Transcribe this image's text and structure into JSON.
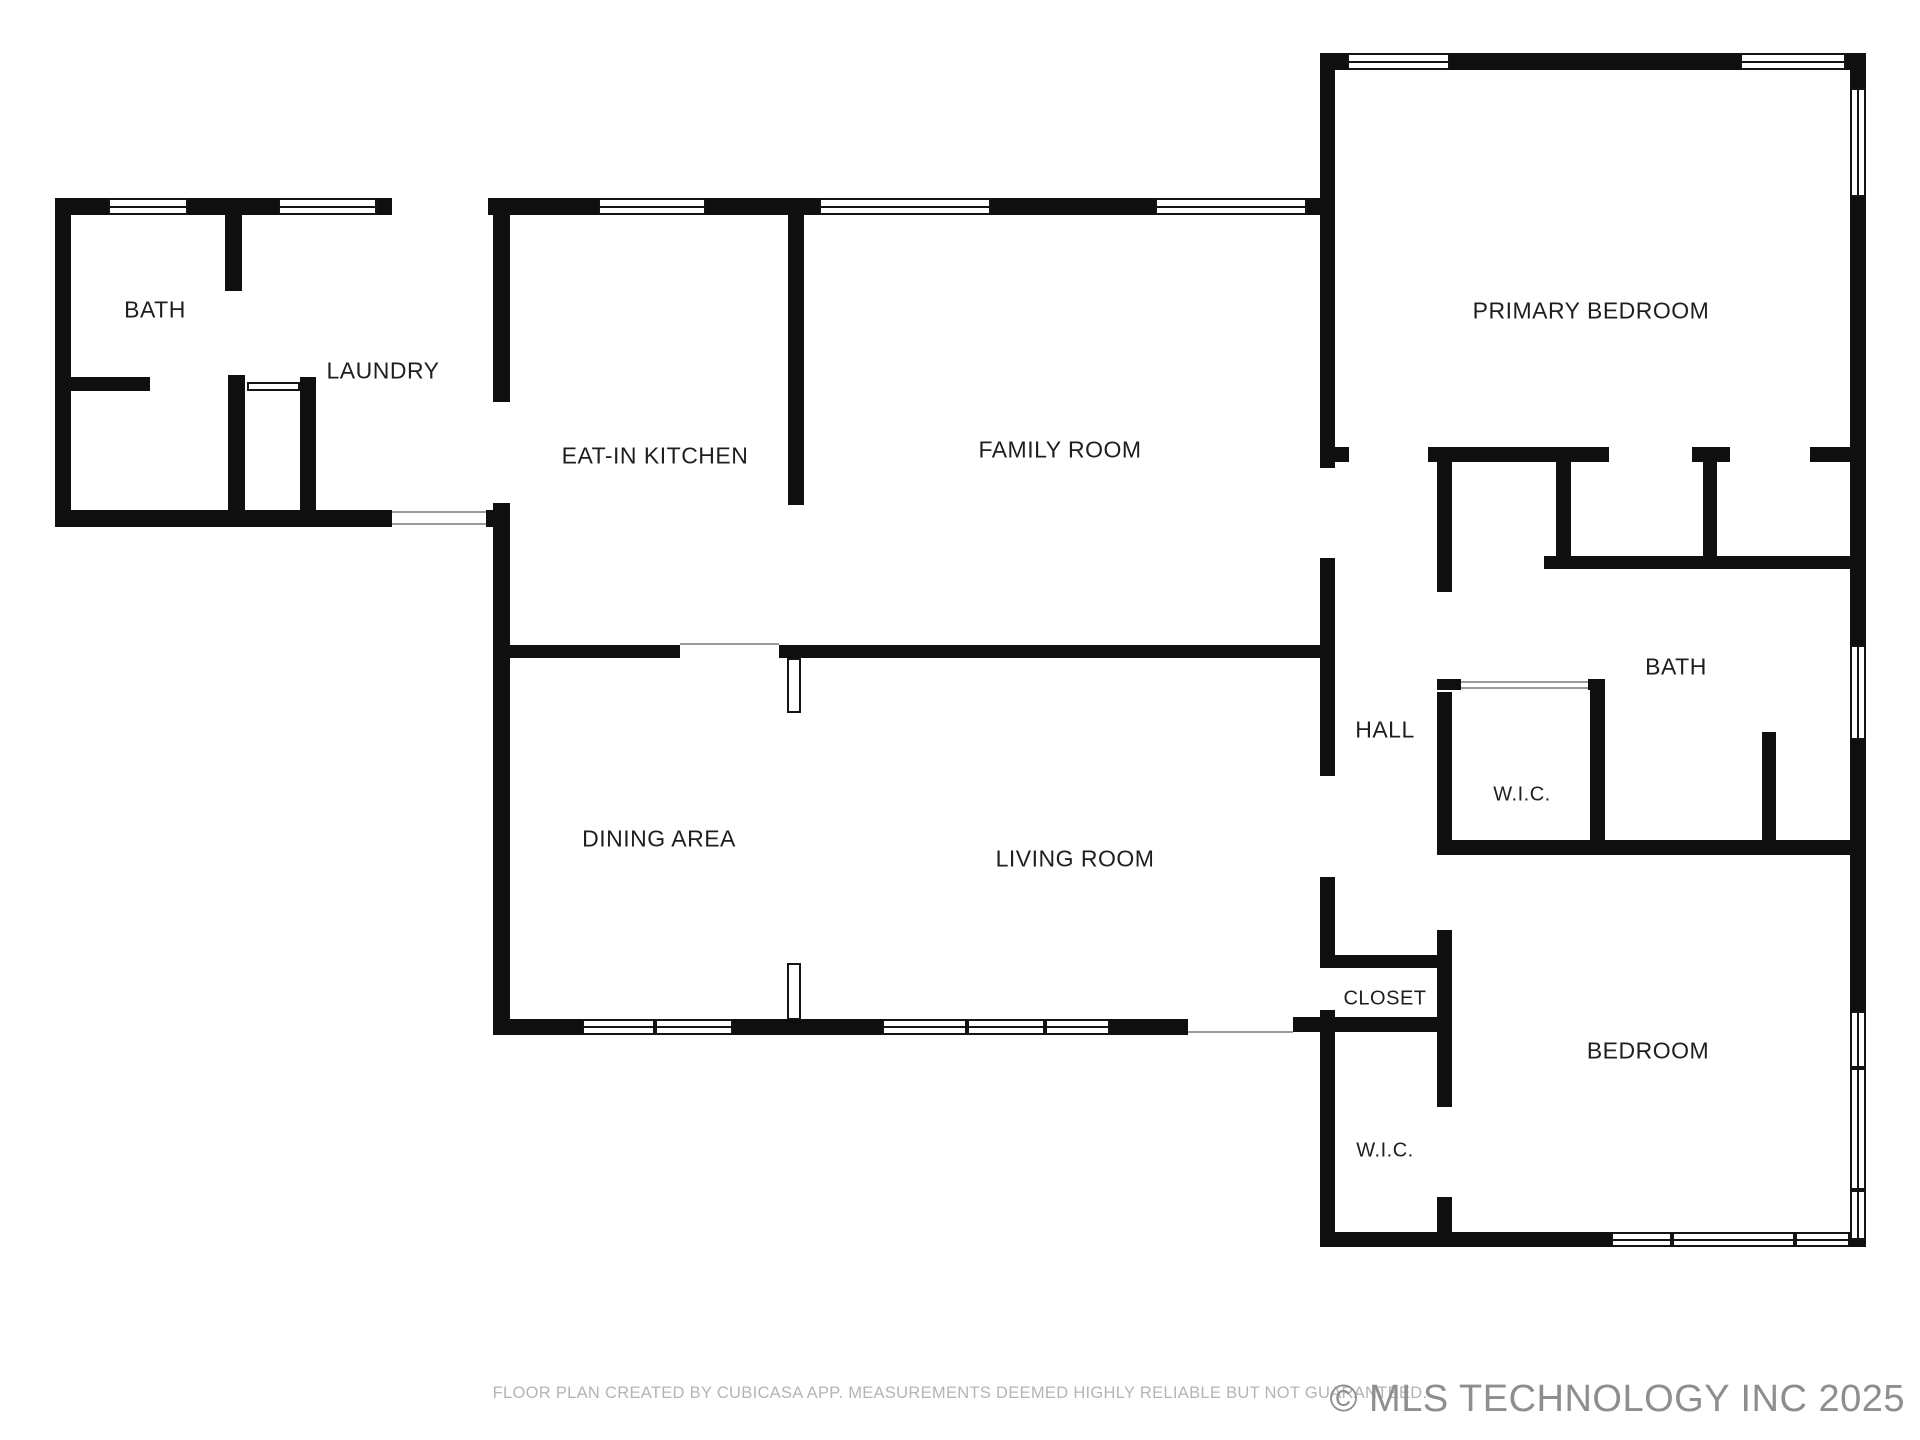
{
  "title": "Residential floor plan",
  "rooms": [
    {
      "id": "bath-1",
      "label": "BATH"
    },
    {
      "id": "laundry",
      "label": "LAUNDRY"
    },
    {
      "id": "eat-in-kitchen",
      "label": "EAT-IN KITCHEN"
    },
    {
      "id": "family-room",
      "label": "FAMILY ROOM"
    },
    {
      "id": "primary-bedroom",
      "label": "PRIMARY BEDROOM"
    },
    {
      "id": "hall",
      "label": "HALL"
    },
    {
      "id": "bath-2",
      "label": "BATH"
    },
    {
      "id": "wic-1",
      "label": "W.I.C."
    },
    {
      "id": "dining-area",
      "label": "DINING AREA"
    },
    {
      "id": "living-room",
      "label": "LIVING ROOM"
    },
    {
      "id": "closet",
      "label": "CLOSET"
    },
    {
      "id": "bedroom",
      "label": "BEDROOM"
    },
    {
      "id": "wic-2",
      "label": "W.I.C."
    }
  ],
  "footer": {
    "disclaimer": "FLOOR PLAN CREATED BY CUBICASA APP. MEASUREMENTS DEEMED HIGHLY RELIABLE BUT NOT GUARANTEED.",
    "copyright": "© MLS TECHNOLOGY INC 2025"
  },
  "colors": {
    "wall": "#0f0f0f",
    "label": "#1e1e1e",
    "disclaimer_text": "#b4b4b4",
    "copyright_text": "#8e8e8e",
    "background": "#ffffff"
  }
}
